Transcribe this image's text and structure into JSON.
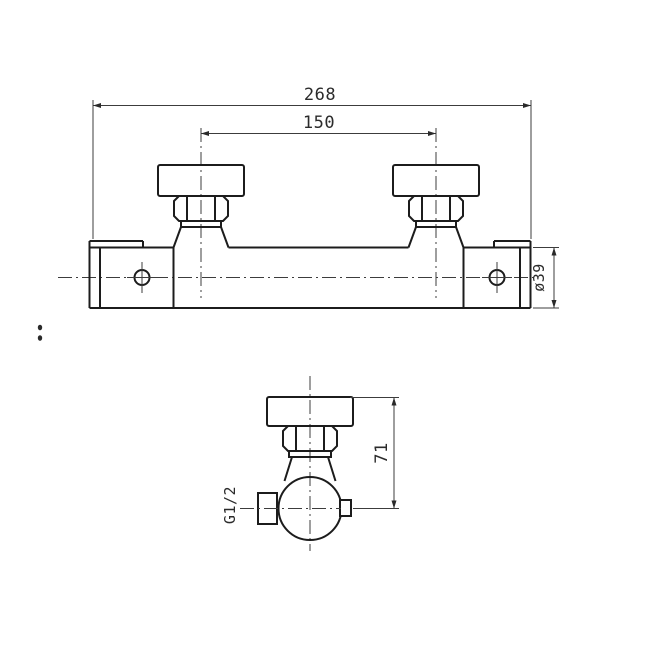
{
  "page": {
    "background": "#ffffff"
  },
  "drawing": {
    "type": "technical-drawing",
    "subject": "thermostatic shower bar mixer valve, two orthographic views",
    "line_color": "#1c1c1c",
    "dimension_color": "#3c3c3c",
    "front_view": {
      "dim_overall_width": "268",
      "dim_valve_spacing": "150",
      "dim_bar_diameter": "ø39"
    },
    "side_view": {
      "dim_cap_to_center_height": "71",
      "label_inlet_thread": "G1/2"
    }
  }
}
